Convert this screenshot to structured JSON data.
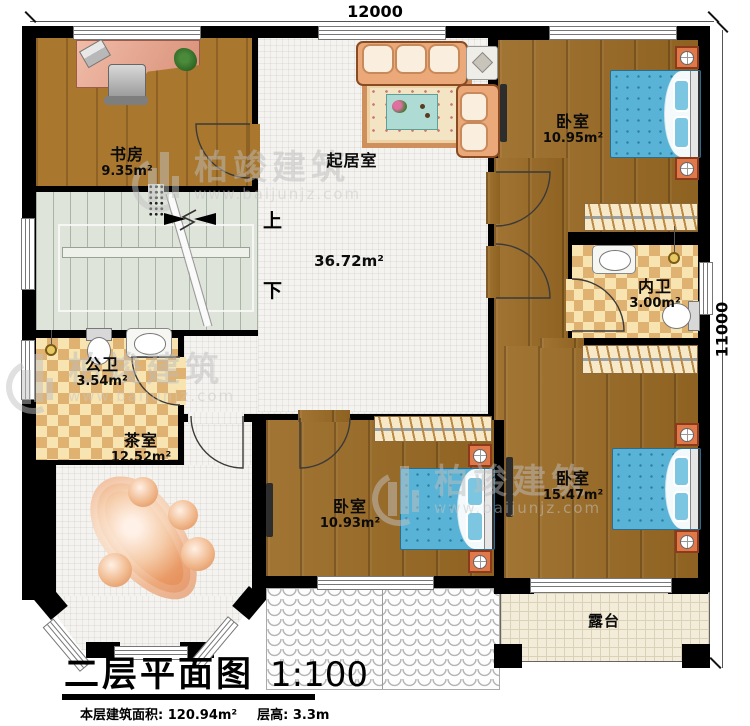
{
  "dimensions": {
    "top": "12000",
    "right": "11000"
  },
  "rooms": {
    "study": {
      "name": "书房",
      "area": "9.35m²"
    },
    "living": {
      "name": "起居室",
      "area": "36.72m²"
    },
    "bedroom1": {
      "name": "卧室",
      "area": "10.95m²"
    },
    "ensuite": {
      "name": "内卫",
      "area": "3.00m²"
    },
    "public_bath": {
      "name": "公卫",
      "area": "3.54m²"
    },
    "tea_room": {
      "name": "茶室",
      "area": "12.52m²"
    },
    "bedroom2": {
      "name": "卧室",
      "area": "15.47m²"
    },
    "bedroom3": {
      "name": "卧室",
      "area": "10.93m²"
    },
    "terrace": {
      "name": "露台"
    }
  },
  "stairs": {
    "up": "上",
    "down": "下"
  },
  "title_block": {
    "title": "二层平面图",
    "scale": "1:100",
    "area_info": "本层建筑面积: 120.94m²",
    "height_info": "层高: 3.3m"
  },
  "watermark": {
    "brand": "柏竣建筑",
    "url": "www.baijunjz.com"
  },
  "colors": {
    "wall": "#000000",
    "wood": "#9a6a24",
    "tile": "#f4f3ef",
    "bath_tile": "#e0b272",
    "stair": "#dfe4da",
    "bed": "#58b3d6",
    "terrace": "#f2ecd8"
  }
}
